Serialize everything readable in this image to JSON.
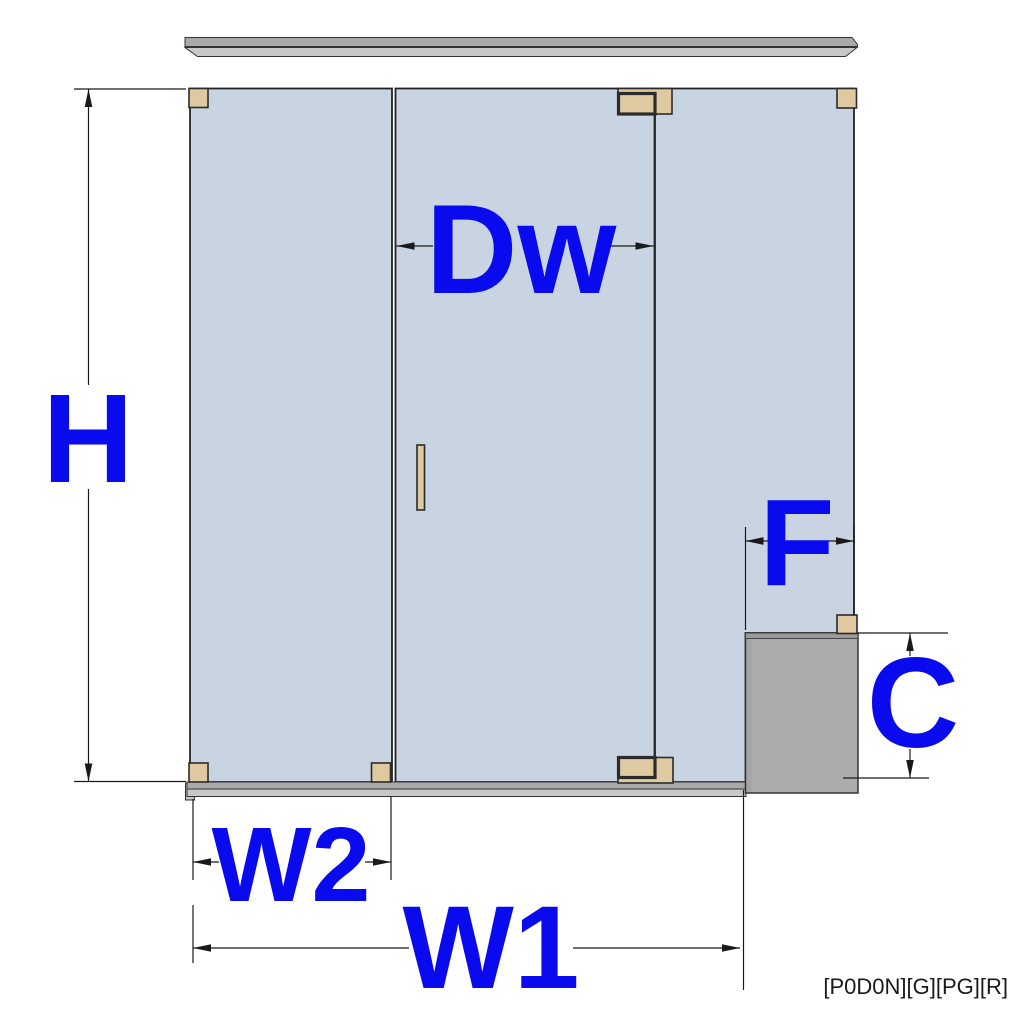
{
  "diagram": {
    "type": "glass-shower-enclosure-dimension-drawing",
    "panels": [
      "fixed-left-panel",
      "hinged-door",
      "fixed-right-panel-notched-over-curb"
    ],
    "hardware": [
      "top-rail",
      "bottom-rail",
      "4 glass clamps",
      "curb clamp",
      "2 door hinges",
      "door handle"
    ]
  },
  "labels": {
    "height": "H",
    "door_width": "Dw",
    "panel2_width": "W2",
    "total_width": "W1",
    "fixed_offset": "F",
    "curb_height": "C"
  },
  "footer": {
    "code": "[P0D0N][G][PG][R]"
  },
  "colors": {
    "background": "#FFFFFF",
    "label": "#0A0AEE",
    "glass": "#C9D4E3",
    "glassline": "#222222",
    "tan": "#DEC9A0",
    "tanline": "#2B2B2B",
    "metaldark": "#AAAAAA",
    "metallight": "#C8C8C8",
    "metalline": "#333333",
    "step": "#ACACAC",
    "steptop": "#9A9A9A",
    "stepleft": "#A3A3A3",
    "dimline": "#1A1A1A"
  }
}
